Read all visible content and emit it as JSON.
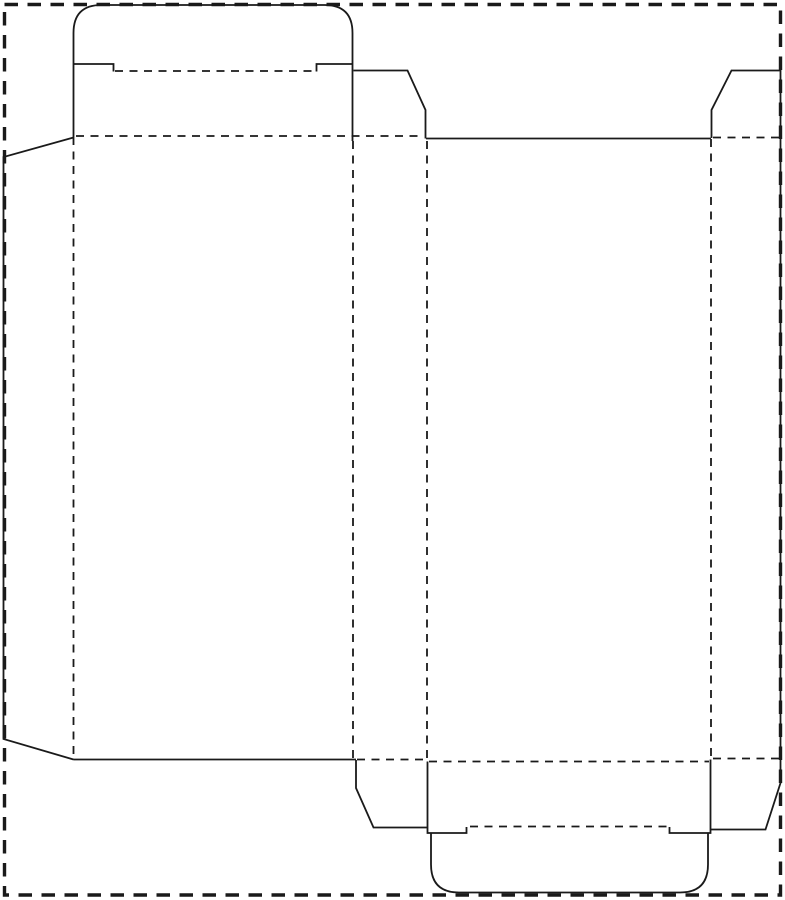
{
  "canvas": {
    "width": 785,
    "height": 900,
    "background_color": "#ffffff",
    "line_color": "#1a1a1a"
  },
  "styles": {
    "cut_line": {
      "stroke_width": 1.8,
      "dash": null
    },
    "fold_line": {
      "stroke_width": 1.8,
      "dash": [
        8,
        6.5
      ]
    },
    "page_border": {
      "stroke_width": 3.4,
      "dash": [
        13.5,
        9.5
      ]
    }
  },
  "page_border_rect": {
    "x": 4.5,
    "y": 4.5,
    "width": 776,
    "height": 890.5
  },
  "dieline": {
    "kind": "reverse-tuck-carton-dieline",
    "fold_lines": [
      {
        "name": "fold-glue-flap-to-panel-a",
        "x1": 73.5,
        "y1": 137,
        "x2": 73.5,
        "y2": 757
      },
      {
        "name": "fold-panel-a-to-panel-b",
        "x1": 353,
        "y1": 141,
        "x2": 353,
        "y2": 758.5
      },
      {
        "name": "fold-panel-b-to-panel-c",
        "x1": 427,
        "y1": 141,
        "x2": 427,
        "y2": 760
      },
      {
        "name": "fold-panel-c-to-panel-d",
        "x1": 711,
        "y1": 139,
        "x2": 711,
        "y2": 757.5
      },
      {
        "name": "fold-top-closure-panel",
        "x1": 76,
        "y1": 136,
        "x2": 424,
        "y2": 136
      },
      {
        "name": "fold-top-dust-flap-right",
        "x1": 713,
        "y1": 137.5,
        "x2": 779,
        "y2": 137.5
      },
      {
        "name": "fold-top-tuck-flap",
        "x1": 115,
        "y1": 71,
        "x2": 316,
        "y2": 71
      },
      {
        "name": "fold-bottom-dust-flap-left",
        "x1": 357,
        "y1": 759.5,
        "x2": 426,
        "y2": 759.5
      },
      {
        "name": "fold-bottom-closure-panel",
        "x1": 429,
        "y1": 761.5,
        "x2": 709,
        "y2": 761.5
      },
      {
        "name": "fold-bottom-dust-flap-right",
        "x1": 713,
        "y1": 758.5,
        "x2": 779,
        "y2": 758.5
      },
      {
        "name": "fold-bottom-tuck-flap",
        "x1": 470,
        "y1": 826.5,
        "x2": 667,
        "y2": 826.5
      }
    ],
    "cut_paths": [
      {
        "name": "glue-flap-outline",
        "d": "M 73.5 137.5 L 3.5 157 L 3.5 739 L 73.5 759.5"
      },
      {
        "name": "top-tuck-flap-outline",
        "d": "M 73.5 137 L 73.5 33 Q 73.5 5 101.5 5 L 324.5 5 Q 352.5 5 352.5 33 L 352.5 141"
      },
      {
        "name": "top-tuck-shoulder-left",
        "d": "M 73.5 64 L 113.5 64 L 113.5 71.5"
      },
      {
        "name": "top-tuck-shoulder-right",
        "d": "M 352.5 64 L 316.5 64 L 316.5 71.5"
      },
      {
        "name": "top-dust-flap-left-outline",
        "d": "M 353.5 70.5 L 407.5 70.5 L 425.5 110 L 425.5 138.5"
      },
      {
        "name": "panel-c-top-edge",
        "d": "M 426 138.5 L 711 138.5"
      },
      {
        "name": "top-dust-flap-right-outline",
        "d": "M 711.5 138 L 711.5 110 L 731.5 70.5 L 780.5 70.5 L 780.5 138"
      },
      {
        "name": "panel-a-bottom-edge",
        "d": "M 73.5 759.5 L 356 759.5"
      },
      {
        "name": "bottom-dust-flap-left-outline",
        "d": "M 356 760 L 356 788 L 373.5 827.5 L 427 827.5"
      },
      {
        "name": "bottom-closure-left-edge",
        "d": "M 427.5 761.5 L 427.5 833 L 466.5 833 L 466.5 827"
      },
      {
        "name": "bottom-closure-right-edge",
        "d": "M 710.5 759.5 L 710.5 833 L 669.5 833 L 669.5 827"
      },
      {
        "name": "bottom-tuck-flap-outline",
        "d": "M 431 833 L 431 864.5 Q 431 892.5 459 892.5 L 680 892.5 Q 708 892.5 708 864.5 L 708 833"
      },
      {
        "name": "bottom-dust-flap-right-outline",
        "d": "M 711 829.5 L 765.5 829.5 L 780.5 783 L 780.5 759"
      },
      {
        "name": "panel-d-right-edge",
        "d": "M 780.5 138 L 780.5 758.5"
      }
    ]
  }
}
